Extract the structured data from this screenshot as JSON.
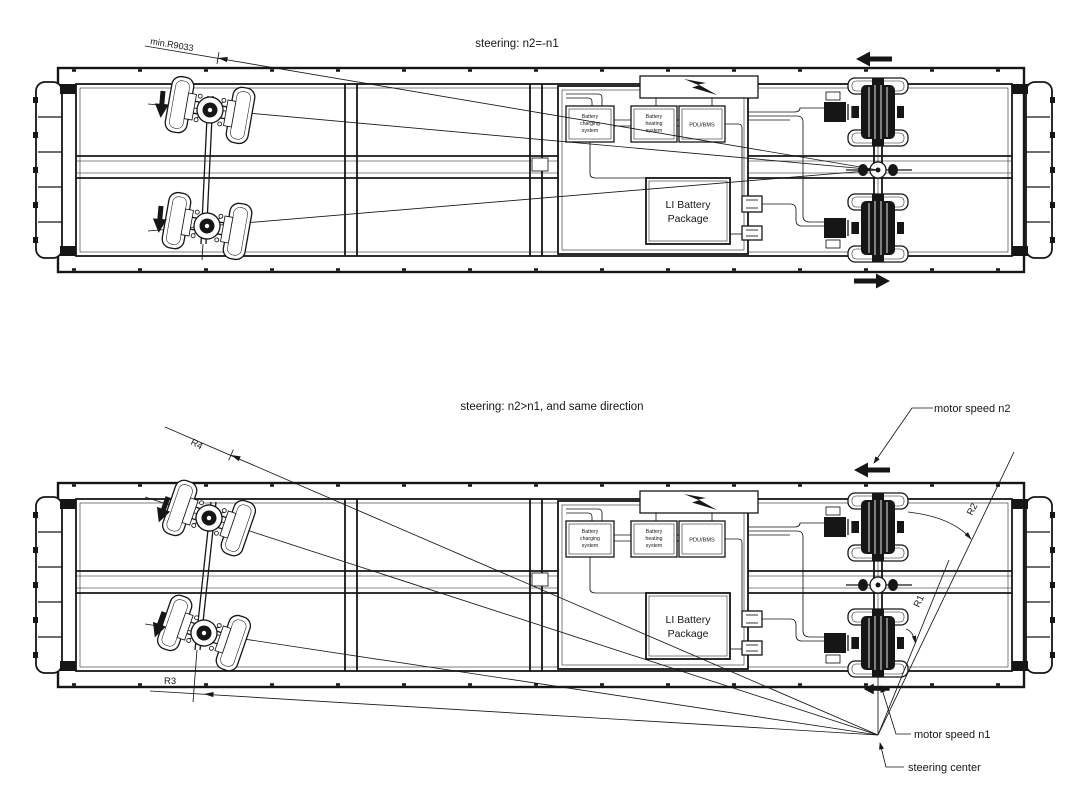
{
  "colors": {
    "line": "#161616",
    "background": "#ffffff"
  },
  "top_diagram": {
    "title": "steering: n2=-n1",
    "min_radius_label": "min.R9033"
  },
  "bottom_diagram": {
    "title": "steering: n2>n1, and  same direction",
    "labels": {
      "r1": "R1",
      "r2": "R2",
      "r3": "R3",
      "r4": "R4"
    },
    "annotations": {
      "motor_speed_n2": "motor speed n2",
      "motor_speed_n1": "motor speed n1",
      "steering_center": "steering center"
    }
  },
  "vehicle": {
    "modules": {
      "charging_l1": "Battery",
      "charging_l2": "charging",
      "charging_l3": "system",
      "heating_l1": "Battery",
      "heating_l2": "heating",
      "heating_l3": "system",
      "pdu_bms": "PDU/BMS",
      "li_l1": "LI Battery",
      "li_l2": "Package"
    }
  }
}
